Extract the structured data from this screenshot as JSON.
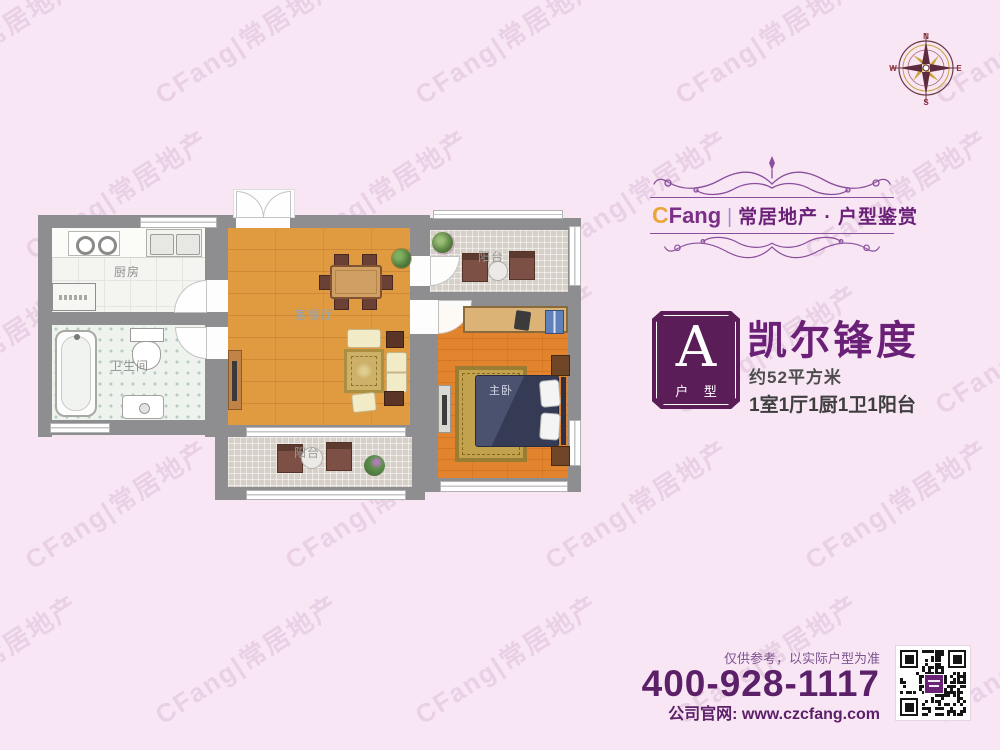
{
  "watermark": {
    "text": "CFang|常居地产"
  },
  "compass": {
    "north": "N",
    "south": "S",
    "east": "E",
    "west": "W"
  },
  "brand": {
    "logo_c": "C",
    "logo_rest": "Fang",
    "divider": "|",
    "tagline": "常居地产 · 户型鉴赏"
  },
  "listing": {
    "badge_letter": "A",
    "badge_caption": "户 型",
    "title": "凯尔锋度",
    "area": "约52平方米",
    "rooms_summary": "1室1厅1厨1卫1阳台"
  },
  "floorplan": {
    "kitchen": "厨房",
    "bathroom": "卫生间",
    "living": "客餐厅",
    "balcony_top": "阳台",
    "bedroom": "主卧",
    "balcony_bottom": "阳台"
  },
  "footer": {
    "disclaimer": "仅供参考，以实际户型为准",
    "phone": "400-928-1117",
    "website": "公司官网: www.czcfang.com"
  },
  "colors": {
    "background_pink": "#f8e6f5",
    "brand_purple": "#6b2177",
    "badge_purple": "#5b1d58",
    "accent_gold": "#e9a63c",
    "wall_gray": "#8e8e90",
    "living_wood": "#e09a40",
    "bedroom_wood": "#e2842e",
    "bed_navy": "#3d4460"
  }
}
